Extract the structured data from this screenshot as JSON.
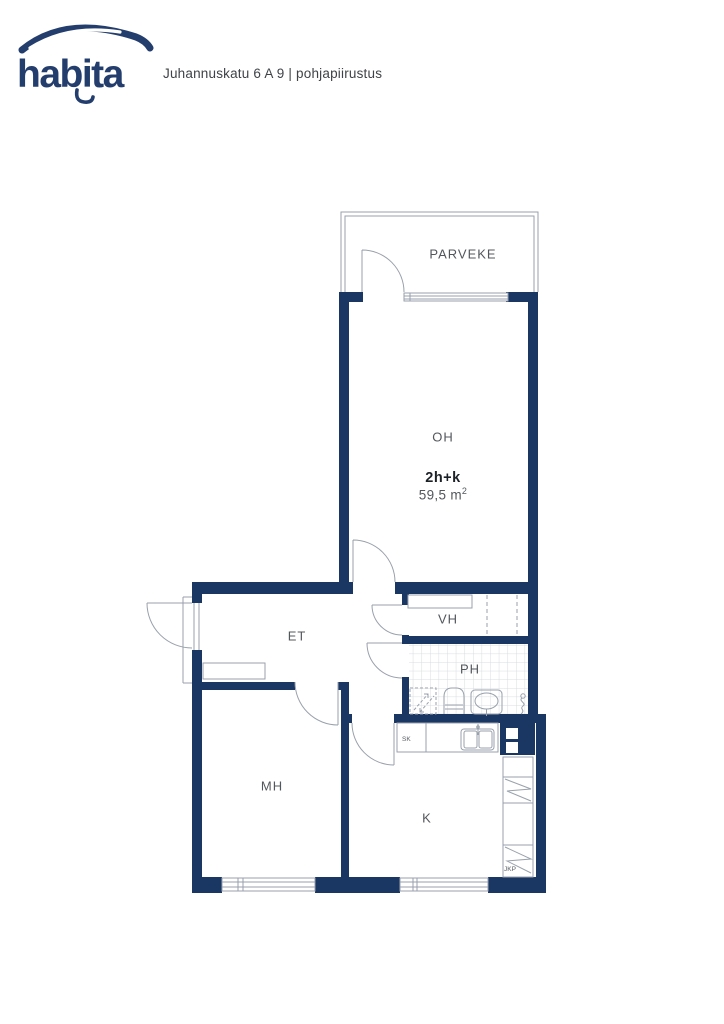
{
  "header": {
    "brand": "habita",
    "address_line": "Juhannuskatu 6 A 9 | pohjapiirustus"
  },
  "plan": {
    "apartment": {
      "layout_code": "2h+k",
      "area_text": "59,5 m",
      "area_sup": "2"
    },
    "rooms": {
      "balcony": "PARVEKE",
      "living": "OH",
      "entry": "ET",
      "closet": "VH",
      "bath": "PH",
      "bedroom": "MH",
      "kitchen": "K"
    },
    "fixtures": {
      "cleaning_closet": "SK",
      "fridge_freezer": "JKP"
    },
    "colors": {
      "wall": "#1a3663",
      "brand": "#233d6d",
      "line": "#99a1ac",
      "label": "#53575c",
      "tile": "#d8dce1"
    }
  }
}
